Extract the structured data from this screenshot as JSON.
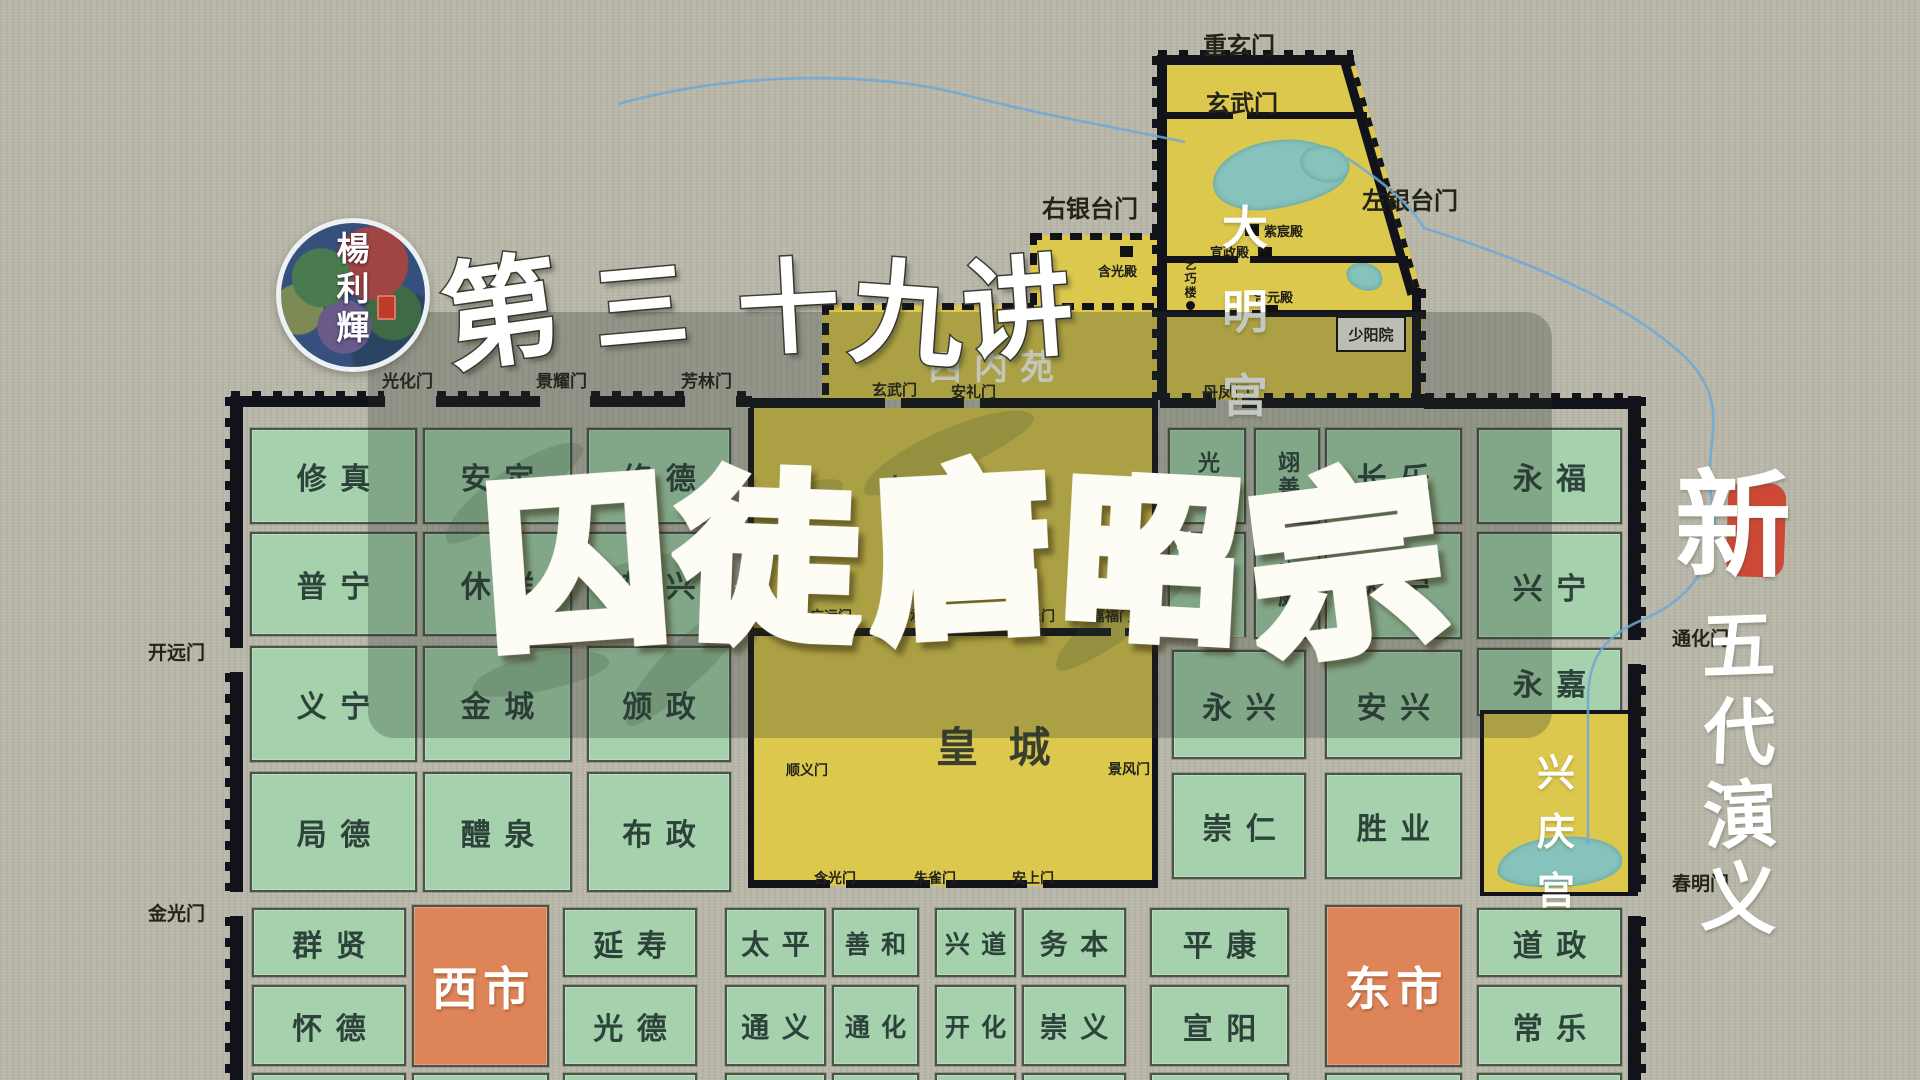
{
  "page_title": "新五代演义 第三十九讲 囚徒唐昭宗",
  "logo": {
    "author_chars": [
      "楊",
      "利",
      "輝"
    ]
  },
  "lecture": {
    "text": "第三十九讲",
    "chars": [
      "第",
      "三",
      "十",
      "九",
      "讲"
    ]
  },
  "main_title": {
    "text": "囚徒唐昭宗",
    "chars": [
      "囚",
      "徒",
      "唐",
      "昭",
      "宗"
    ]
  },
  "series": {
    "badge": "新",
    "name_chars": [
      "五",
      "代",
      "演",
      "义"
    ]
  },
  "colors": {
    "paper": "#b8b7a9",
    "ward_green": "#a5d1ac",
    "palace_yellow": "#ddc84e",
    "market_orange": "#dd8458",
    "lake_teal": "#85c3bc",
    "river_blue": "#6fa8d6",
    "wall_black": "#12121a",
    "seal_red": "#cd4936",
    "gold_top": "#fff04d",
    "gold_bottom": "#e86a05"
  },
  "map": {
    "wards": [
      {
        "name": "修真"
      },
      {
        "name": "安定"
      },
      {
        "name": "修德"
      },
      {
        "name": "普宁"
      },
      {
        "name": "休祥"
      },
      {
        "name": "辅兴"
      },
      {
        "name": "义宁"
      },
      {
        "name": "金城"
      },
      {
        "name": "颁政"
      },
      {
        "name": "局德"
      },
      {
        "name": "醴泉"
      },
      {
        "name": "布政"
      },
      {
        "name": "群贤"
      },
      {
        "name": "怀德"
      },
      {
        "name": "西市",
        "type": "market"
      },
      {
        "name": "延寿"
      },
      {
        "name": "光德"
      },
      {
        "name": "太平"
      },
      {
        "name": "通义"
      },
      {
        "name": "善和"
      },
      {
        "name": "通化"
      },
      {
        "name": "兴道"
      },
      {
        "name": "开化"
      },
      {
        "name": "务本"
      },
      {
        "name": "崇义"
      },
      {
        "name": "平康"
      },
      {
        "name": "宣阳"
      },
      {
        "name": "东市",
        "type": "market"
      },
      {
        "name": "道政"
      },
      {
        "name": "常乐"
      },
      {
        "name": "光宅",
        "type": "vertical"
      },
      {
        "name": "翊善",
        "type": "vertical"
      },
      {
        "name": "长乐"
      },
      {
        "name": "永福"
      },
      {
        "name": ""
      },
      {
        "name": "来庭",
        "type": "vertical"
      },
      {
        "name": "大宁"
      },
      {
        "name": "兴宁"
      },
      {
        "name": "永兴"
      },
      {
        "name": "安兴"
      },
      {
        "name": "永嘉"
      },
      {
        "name": "崇仁"
      },
      {
        "name": "胜业"
      },
      {
        "name": ""
      },
      {
        "name": ""
      },
      {
        "name": ""
      },
      {
        "name": ""
      },
      {
        "name": ""
      },
      {
        "name": ""
      },
      {
        "name": ""
      },
      {
        "name": ""
      },
      {
        "name": ""
      },
      {
        "name": ""
      }
    ],
    "areas": {
      "daming_palace_chars": [
        "大",
        "明",
        "宫"
      ],
      "xineiyuan": "西内苑",
      "taijigong": "太 极 宫",
      "huangcheng": "皇  城",
      "xingqing_chars": [
        "兴",
        "庆",
        "宫"
      ]
    },
    "halls": {
      "hanguangdian": "含光殿",
      "zichendian": "紫宸殿",
      "xuanzhengdian": "宣政殿",
      "hanyuandian": "含元殿",
      "qiqiaolou": "乞巧楼",
      "shaoyangyuan": "少阳院"
    },
    "gates": [
      {
        "name": "重玄门"
      },
      {
        "name": "玄武门"
      },
      {
        "name": "右银台门"
      },
      {
        "name": "左银台门"
      },
      {
        "name": "丹凤门"
      },
      {
        "name": "光化门"
      },
      {
        "name": "景耀门"
      },
      {
        "name": "芳林门"
      },
      {
        "name": "玄武门"
      },
      {
        "name": "安礼门"
      },
      {
        "name": "开远门"
      },
      {
        "name": "金光门"
      },
      {
        "name": "通化门"
      },
      {
        "name": "春明门"
      },
      {
        "name": "广运门"
      },
      {
        "name": "承天门"
      },
      {
        "name": "长乐门"
      },
      {
        "name": "嘉福门"
      },
      {
        "name": "顺义门"
      },
      {
        "name": "景风门"
      },
      {
        "name": "含光门"
      },
      {
        "name": "朱雀门"
      },
      {
        "name": "安上门"
      }
    ]
  }
}
